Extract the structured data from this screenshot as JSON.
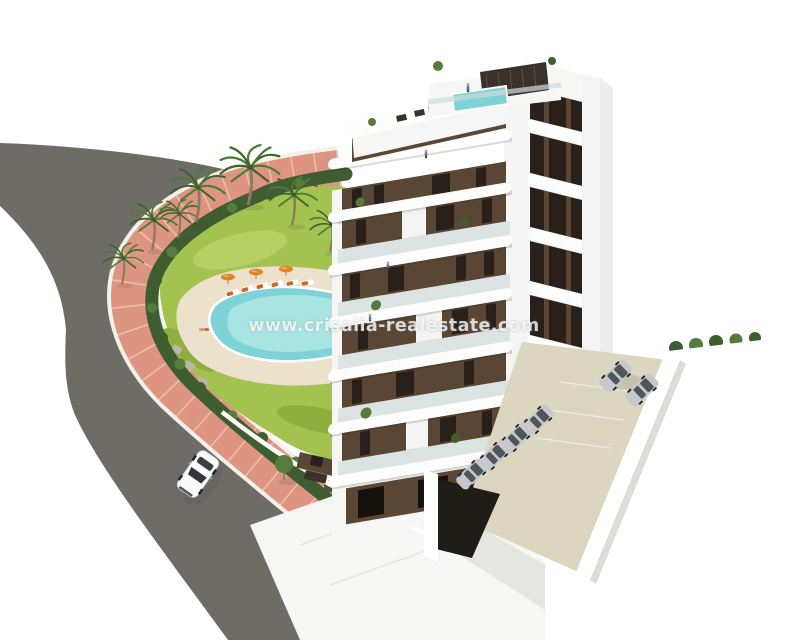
{
  "image": {
    "kind": "3d-architectural-render",
    "subject": "white-and-brown multi-storey apartment building with rooftop terraces, garden with free-form pool, palm trees, curved road with one white car, and a side parking area with parked cars"
  },
  "watermark": {
    "text": "www.crisalia-realestate.com"
  },
  "counts": {
    "building_floors": 7,
    "palm_trees": 7,
    "parasols": 3,
    "cars_on_road": 1,
    "cars_parked": 6
  },
  "colors": {
    "background": "#ffffff",
    "road": "#74716b",
    "curb": "#f3efe9",
    "sidewalk": "#dd9480",
    "sidewalk_joint": "#f2c4b2",
    "hedge": "#3e5d30",
    "hedge_light": "#567c3c",
    "grass": "#a4c250",
    "grass_light": "#b7d066",
    "grass_dark": "#8fae3e",
    "pool_deck": "#ece2cb",
    "pool_water": "#7fd3d6",
    "pool_water_light": "#a8e4e2",
    "palm_green": "#4e7b39",
    "palm_green_dark": "#3c642c",
    "palm_trunk": "#8a7b5e",
    "facade_brown": "#5a4634",
    "facade_brown_dark": "#463527",
    "window_dark": "#28211b",
    "glass": "#c9d6d9",
    "pergola": "#3a322a",
    "parking_ground": "#dcd5c0",
    "parasol_orange": "#df8428",
    "car_white": "#fafafa",
    "car_silver": "#c6c9cc",
    "car_dark": "#32373d"
  }
}
